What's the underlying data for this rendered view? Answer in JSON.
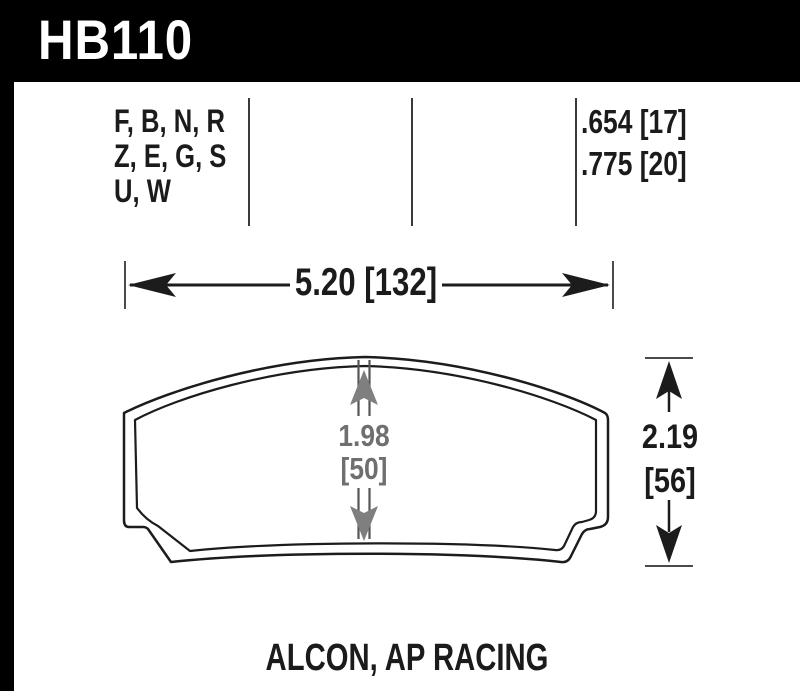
{
  "header": {
    "part_number": "HB110"
  },
  "spec": {
    "compounds": [
      "F, B, N, R",
      "Z, E, G, S",
      "U, W"
    ],
    "thicknesses": [
      ".654 [17]",
      ".775 [20]"
    ]
  },
  "dims": {
    "width": "5.20 [132]",
    "center_height_in": "1.98",
    "center_height_mm": "[50]",
    "overall_height_in": "2.19",
    "overall_height_mm": "[56]"
  },
  "footer": {
    "fitment": "ALCON, AP RACING"
  },
  "colors": {
    "bar": "#000000",
    "ink": "#1b1b1b",
    "dim_gray": "#6f6f6f"
  }
}
